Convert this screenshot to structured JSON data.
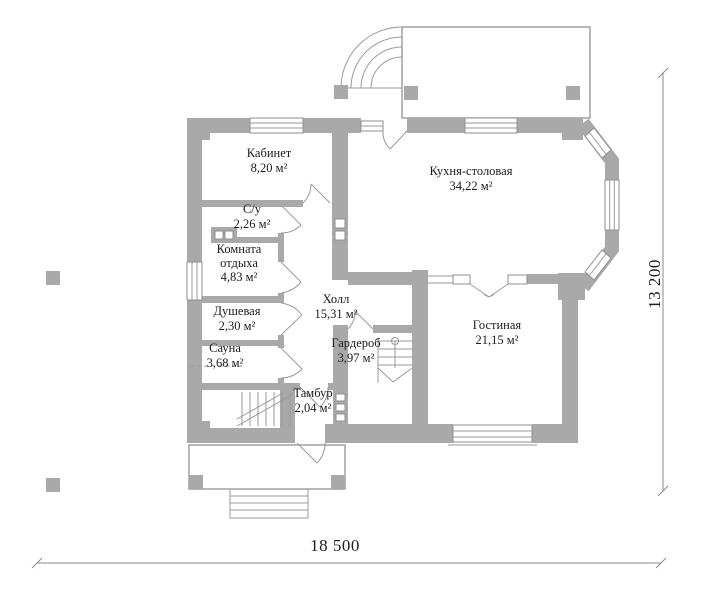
{
  "title": "План первого этажа",
  "colors": {
    "wall": "#a9a9a9",
    "line": "#9a9a9a",
    "text": "#1c1c1c",
    "bg": "#ffffff"
  },
  "rooms": [
    {
      "id": "kabinet",
      "name": "Кабинет",
      "area": "8,20 м²"
    },
    {
      "id": "su",
      "name": "С/у",
      "area": "2,26 м²"
    },
    {
      "id": "komnata-otdyha",
      "name": "Комната отдыха",
      "area": "4,83 м²"
    },
    {
      "id": "dushevaya",
      "name": "Душевая",
      "area": "2,30 м²"
    },
    {
      "id": "sauna",
      "name": "Сауна",
      "area": "3,68 м²"
    },
    {
      "id": "holl",
      "name": "Холл",
      "area": "15,31 м²"
    },
    {
      "id": "garderob",
      "name": "Гардероб",
      "area": "3,97 м²"
    },
    {
      "id": "tambur",
      "name": "Тамбур",
      "area": "2,04 м²"
    },
    {
      "id": "kuhnya-stolovaya",
      "name": "Кухня-столовая",
      "area": "34,22 м²"
    },
    {
      "id": "gostinaya",
      "name": "Гостиная",
      "area": "21,15 м²"
    }
  ],
  "dimensions": {
    "width_label": "18 500",
    "height_label": "13 200"
  }
}
